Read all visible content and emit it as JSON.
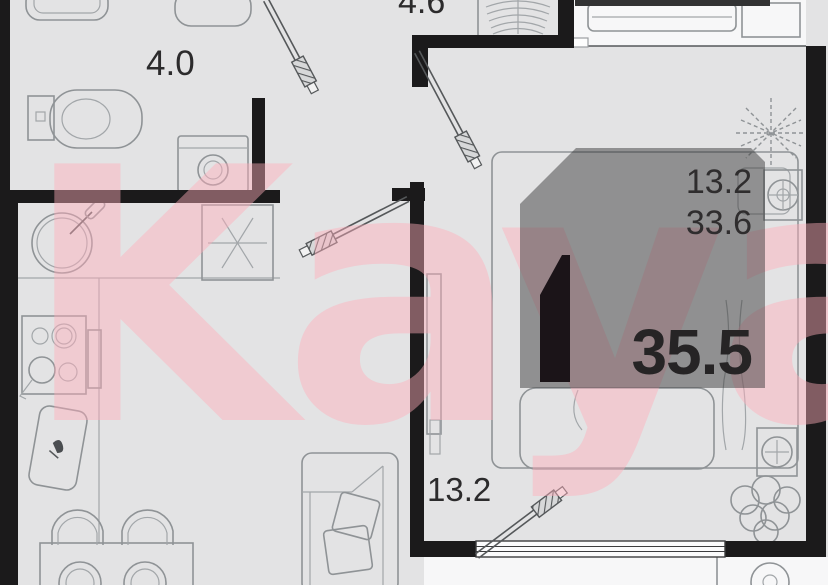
{
  "floorplan": {
    "room_labels": {
      "bathroom_area": "4.0",
      "hall_area_partial": "4.6",
      "bedroom_area": "13.2"
    },
    "area_badge": {
      "room_area": "13.2",
      "living_area": "33.6",
      "total_area": "35.5"
    },
    "watermark_text": "Kayan",
    "colors": {
      "floor": "#e3e3e4",
      "wall": "#1b1a1b",
      "furniture_line": "#8f9396",
      "balcony": "#f7f7f8",
      "watermark_pink": "rgba(255,172,186,0.45)",
      "badge_overlay": "rgba(52,50,52,0.47)",
      "badge_text": "#2f2d2e",
      "badge_total_text": "#262425"
    }
  }
}
